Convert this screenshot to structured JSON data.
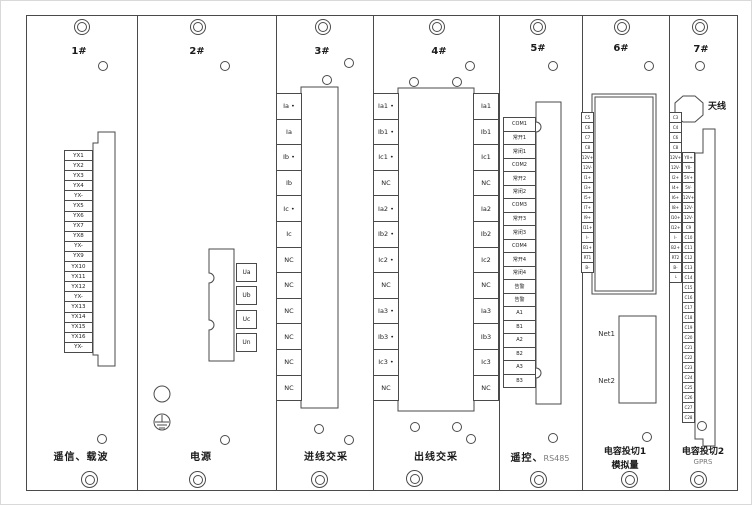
{
  "panel_modules": [
    {
      "num": "1#",
      "label": "遥信、载波",
      "cells": [
        "YX1",
        "YX2",
        "YX3",
        "YX4",
        "YX-",
        "YX5",
        "YX6",
        "YX7",
        "YX8",
        "YX-",
        "YX9",
        "YX10",
        "YX11",
        "YX12",
        "YX-",
        "YX13",
        "YX14",
        "YX15",
        "YX16",
        "YX-"
      ]
    },
    {
      "num": "2#",
      "label": "电源",
      "voltage_cells": [
        "Ua",
        "Ub",
        "Uc",
        "Un"
      ]
    },
    {
      "num": "3#",
      "label": "进线交采",
      "cells": [
        "Ia •",
        "Ia",
        "Ib •",
        "Ib",
        "Ic •",
        "Ic",
        "NC",
        "NC",
        "NC",
        "NC",
        "NC",
        "NC"
      ]
    },
    {
      "num": "4#",
      "label": "出线交采",
      "cells_left": [
        "Ia1 •",
        "Ib1 •",
        "Ic1 •",
        "NC",
        "Ia2 •",
        "Ib2 •",
        "Ic2 •",
        "NC",
        "Ia3 •",
        "Ib3 •",
        "Ic3 •",
        "NC"
      ],
      "cells_right": [
        "Ia1",
        "Ib1",
        "Ic1",
        "NC",
        "Ia2",
        "Ib2",
        "Ic2",
        "NC",
        "Ia3",
        "Ib3",
        "Ic3",
        "NC"
      ]
    },
    {
      "num": "5#",
      "label_cn": "遥控、",
      "label_code": "RS485",
      "cells": [
        "COM1",
        "常开1",
        "常闭1",
        "COM2",
        "常开2",
        "常闭2",
        "COM3",
        "常开3",
        "常闭3",
        "COM4",
        "常开4",
        "常闭4",
        "告警",
        "告警",
        "A1",
        "B1",
        "A2",
        "B2",
        "A3",
        "B3"
      ]
    },
    {
      "num": "6#",
      "label_line1": "电容投切1",
      "label_line2": "模拟量",
      "net_ports": [
        "Net1",
        "Net2"
      ],
      "cells": [
        "C5",
        "C6",
        "C7",
        "C8",
        "12V+",
        "12V-",
        "I1+",
        "I3+",
        "I5+",
        "I7+",
        "I9+",
        "I11+",
        "I-",
        "B1+",
        "RT1",
        "B-"
      ]
    },
    {
      "num": "7#",
      "label_line1": "电容投切2",
      "label_line2": "GPRS",
      "antenna": "天线",
      "cells_col1": [
        "C3",
        "C4",
        "C6",
        "C8",
        "12V+",
        "12V-",
        "I2+",
        "I4+",
        "I6+",
        "I8+",
        "I10+",
        "I12+",
        "I-",
        "B2+",
        "RT2",
        "B-",
        "└"
      ],
      "cells_col2": [
        "Y0+",
        "Y0-",
        "5V+",
        "5V-",
        "12V+",
        "12V-",
        "12V-",
        "C9",
        "C10",
        "C11",
        "C12",
        "C13",
        "C14",
        "C15",
        "C16",
        "C17",
        "C18",
        "C19",
        "C20",
        "C21",
        "C22",
        "C23",
        "C24",
        "C25",
        "C26",
        "C27",
        "C28"
      ]
    }
  ]
}
